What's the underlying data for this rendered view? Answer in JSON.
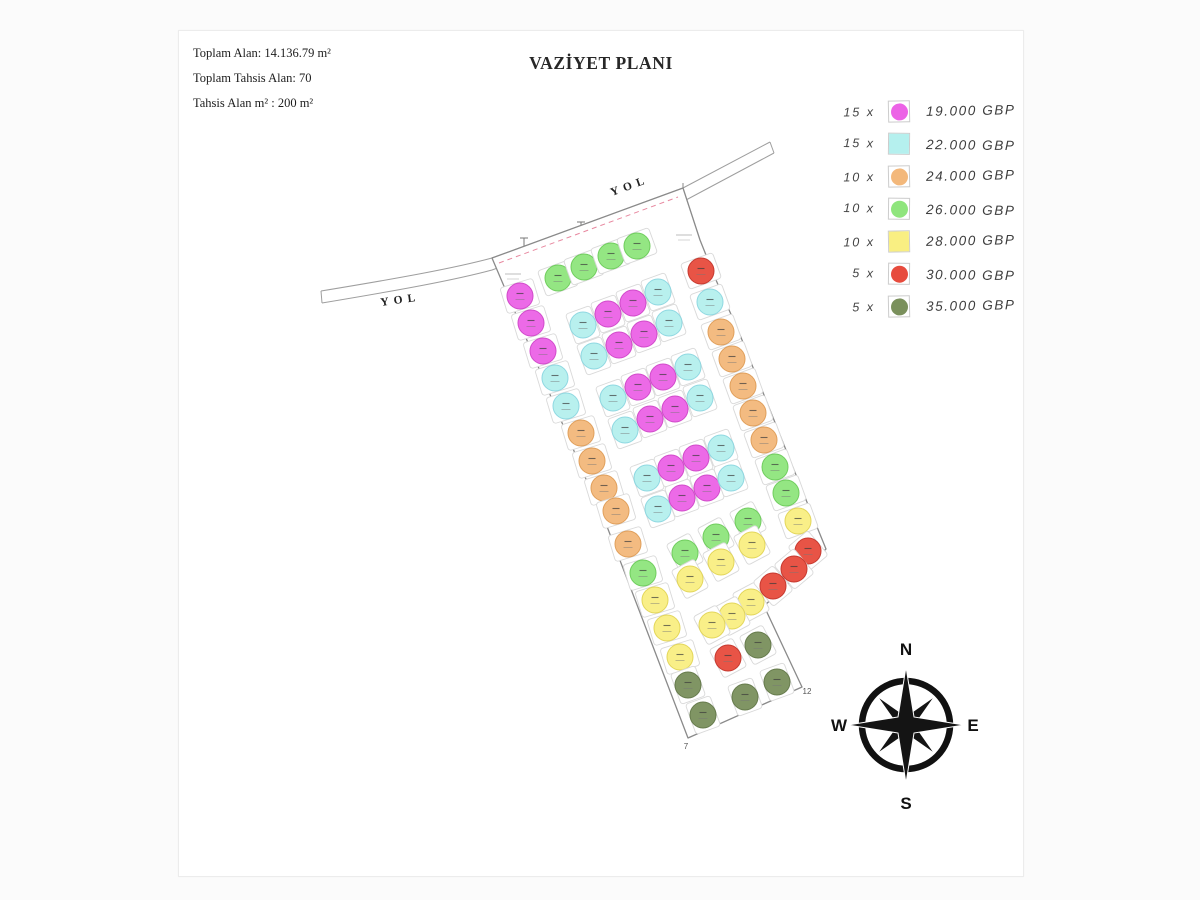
{
  "page": {
    "title": "VAZİYET PLANI",
    "info_lines": [
      "Toplam Alan: 14.136.79 m²",
      "Toplam Tahsis Alan: 70",
      "Tahsis Alan m² : 200 m²"
    ]
  },
  "legend": {
    "items": [
      {
        "count": "15 x",
        "price": "19.000 GBP",
        "color_key": "m",
        "shape": "circle-square"
      },
      {
        "count": "15 x",
        "price": "22.000 GBP",
        "color_key": "c",
        "shape": "square"
      },
      {
        "count": "10 x",
        "price": "24.000 GBP",
        "color_key": "o",
        "shape": "circle-square"
      },
      {
        "count": "10 x",
        "price": "26.000 GBP",
        "color_key": "g",
        "shape": "circle-square"
      },
      {
        "count": "10 x",
        "price": "28.000 GBP",
        "color_key": "y",
        "shape": "square"
      },
      {
        "count": "5 x",
        "price": "30.000 GBP",
        "color_key": "r",
        "shape": "circle-square"
      },
      {
        "count": "5 x",
        "price": "35.000 GBP",
        "color_key": "d",
        "shape": "circle-square"
      }
    ]
  },
  "colors": {
    "m": {
      "fill": "#ec63e6",
      "stroke": "#cf41c8"
    },
    "c": {
      "fill": "#b5f0ee",
      "stroke": "#89d6e0"
    },
    "o": {
      "fill": "#f3b87b",
      "stroke": "#df9a52"
    },
    "g": {
      "fill": "#8fe57d",
      "stroke": "#68cb55"
    },
    "y": {
      "fill": "#f9ef82",
      "stroke": "#e2d451"
    },
    "r": {
      "fill": "#e74b3d",
      "stroke": "#c42f24"
    },
    "d": {
      "fill": "#7a905c",
      "stroke": "#5e7443"
    }
  },
  "plan": {
    "road_label": "YOL",
    "road_labels": [
      {
        "x": 612,
        "y": 196,
        "rot": -20
      },
      {
        "x": 381,
        "y": 306,
        "rot": -8
      }
    ],
    "outline": [
      [
        492,
        258
      ],
      [
        683,
        188
      ],
      [
        700,
        240
      ],
      [
        716,
        280
      ],
      [
        740,
        335
      ],
      [
        766,
        400
      ],
      [
        792,
        465
      ],
      [
        815,
        522
      ],
      [
        826,
        549
      ],
      [
        764,
        606
      ],
      [
        802,
        687
      ],
      [
        688,
        738
      ],
      [
        598,
        503
      ],
      [
        594,
        498
      ]
    ],
    "corner_labels": [
      {
        "x": 686,
        "y": 749,
        "t": "7"
      },
      {
        "x": 807,
        "y": 694,
        "t": "12"
      }
    ],
    "poles": [
      {
        "x": 524,
        "y": 238
      },
      {
        "x": 581,
        "y": 222
      },
      {
        "x": 641,
        "y": 206
      }
    ],
    "note_marks": [
      {
        "x": 513,
        "y": 274
      },
      {
        "x": 684,
        "y": 235
      }
    ],
    "plots": [
      {
        "x": 520,
        "y": 296,
        "c": "m",
        "t": "e"
      },
      {
        "x": 531,
        "y": 323,
        "c": "m",
        "t": "e"
      },
      {
        "x": 543,
        "y": 351,
        "c": "m",
        "t": "e"
      },
      {
        "x": 555,
        "y": 378,
        "c": "c",
        "t": "e"
      },
      {
        "x": 566,
        "y": 406,
        "c": "c",
        "t": "e"
      },
      {
        "x": 581,
        "y": 433,
        "c": "o",
        "t": "e"
      },
      {
        "x": 592,
        "y": 461,
        "c": "o",
        "t": "e"
      },
      {
        "x": 604,
        "y": 488,
        "c": "o",
        "t": "e"
      },
      {
        "x": 616,
        "y": 511,
        "c": "o",
        "t": "e"
      },
      {
        "x": 628,
        "y": 544,
        "c": "o",
        "t": "e"
      },
      {
        "x": 643,
        "y": 573,
        "c": "g",
        "t": "e"
      },
      {
        "x": 655,
        "y": 600,
        "c": "y",
        "t": "e"
      },
      {
        "x": 667,
        "y": 628,
        "c": "y",
        "t": "e"
      },
      {
        "x": 680,
        "y": 657,
        "c": "y",
        "t": "e"
      },
      {
        "x": 558,
        "y": 278,
        "c": "g",
        "t": "e",
        "r": -20
      },
      {
        "x": 584,
        "y": 267,
        "c": "g",
        "t": "e",
        "r": -20
      },
      {
        "x": 611,
        "y": 256,
        "c": "g",
        "t": "e",
        "r": -20
      },
      {
        "x": 637,
        "y": 246,
        "c": "g",
        "t": "e",
        "r": -20
      },
      {
        "x": 583,
        "y": 325,
        "c": "c",
        "r": -20
      },
      {
        "x": 608,
        "y": 314,
        "c": "m",
        "r": -20
      },
      {
        "x": 633,
        "y": 303,
        "c": "m",
        "r": -20
      },
      {
        "x": 658,
        "y": 292,
        "c": "c",
        "r": -20
      },
      {
        "x": 594,
        "y": 356,
        "c": "c",
        "r": -20
      },
      {
        "x": 619,
        "y": 345,
        "c": "m",
        "r": -20
      },
      {
        "x": 644,
        "y": 334,
        "c": "m",
        "r": -20
      },
      {
        "x": 669,
        "y": 323,
        "c": "c",
        "r": -20
      },
      {
        "x": 613,
        "y": 398,
        "c": "c",
        "r": -20
      },
      {
        "x": 638,
        "y": 387,
        "c": "m",
        "r": -20
      },
      {
        "x": 663,
        "y": 377,
        "c": "m",
        "r": -20
      },
      {
        "x": 688,
        "y": 367,
        "c": "c",
        "r": -20
      },
      {
        "x": 625,
        "y": 430,
        "c": "c",
        "r": -20
      },
      {
        "x": 650,
        "y": 419,
        "c": "m",
        "r": -20
      },
      {
        "x": 675,
        "y": 409,
        "c": "m",
        "r": -20
      },
      {
        "x": 700,
        "y": 398,
        "c": "c",
        "r": -20
      },
      {
        "x": 647,
        "y": 478,
        "c": "c",
        "r": -20
      },
      {
        "x": 671,
        "y": 468,
        "c": "m",
        "r": -20
      },
      {
        "x": 696,
        "y": 458,
        "c": "m",
        "r": -20
      },
      {
        "x": 721,
        "y": 448,
        "c": "c",
        "r": -20
      },
      {
        "x": 658,
        "y": 509,
        "c": "c",
        "r": -20
      },
      {
        "x": 682,
        "y": 498,
        "c": "m",
        "r": -20
      },
      {
        "x": 707,
        "y": 488,
        "c": "m",
        "r": -20
      },
      {
        "x": 731,
        "y": 478,
        "c": "c",
        "r": -20
      },
      {
        "x": 701,
        "y": 271,
        "c": "r",
        "t": "e",
        "r": -20
      },
      {
        "x": 710,
        "y": 302,
        "c": "c",
        "t": "e",
        "r": -20
      },
      {
        "x": 721,
        "y": 332,
        "c": "o",
        "t": "e",
        "r": -20
      },
      {
        "x": 732,
        "y": 359,
        "c": "o",
        "t": "e",
        "r": -20
      },
      {
        "x": 743,
        "y": 386,
        "c": "o",
        "t": "e",
        "r": -20
      },
      {
        "x": 753,
        "y": 413,
        "c": "o",
        "t": "e",
        "r": -20
      },
      {
        "x": 764,
        "y": 440,
        "c": "o",
        "t": "e",
        "r": -20
      },
      {
        "x": 775,
        "y": 467,
        "c": "g",
        "t": "e",
        "r": -20
      },
      {
        "x": 786,
        "y": 493,
        "c": "g",
        "t": "e",
        "r": -20
      },
      {
        "x": 798,
        "y": 521,
        "c": "y",
        "t": "e",
        "r": -20
      },
      {
        "x": 748,
        "y": 521,
        "c": "g",
        "r": -28
      },
      {
        "x": 716,
        "y": 537,
        "c": "g",
        "r": -28
      },
      {
        "x": 685,
        "y": 553,
        "c": "g",
        "r": -28
      },
      {
        "x": 752,
        "y": 545,
        "c": "y",
        "r": -28
      },
      {
        "x": 721,
        "y": 562,
        "c": "y",
        "r": -28
      },
      {
        "x": 690,
        "y": 579,
        "c": "y",
        "r": -28
      },
      {
        "x": 751,
        "y": 602,
        "c": "y",
        "r": -28
      },
      {
        "x": 732,
        "y": 616,
        "c": "y",
        "r": -28
      },
      {
        "x": 712,
        "y": 625,
        "c": "y",
        "r": -28
      },
      {
        "x": 728,
        "y": 658,
        "c": "r",
        "r": -28
      },
      {
        "x": 808,
        "y": 551,
        "c": "r",
        "r": -40
      },
      {
        "x": 794,
        "y": 569,
        "c": "r",
        "r": -40
      },
      {
        "x": 773,
        "y": 586,
        "c": "r",
        "r": -40
      },
      {
        "x": 758,
        "y": 645,
        "c": "d",
        "r": -28
      },
      {
        "x": 777,
        "y": 682,
        "c": "d",
        "r": -20
      },
      {
        "x": 745,
        "y": 697,
        "c": "d",
        "r": -20
      },
      {
        "x": 703,
        "y": 715,
        "c": "d",
        "r": -20
      },
      {
        "x": 688,
        "y": 685,
        "c": "d",
        "r": -20
      }
    ]
  },
  "compass": {
    "n": "N",
    "s": "S",
    "e": "E",
    "w": "W"
  }
}
